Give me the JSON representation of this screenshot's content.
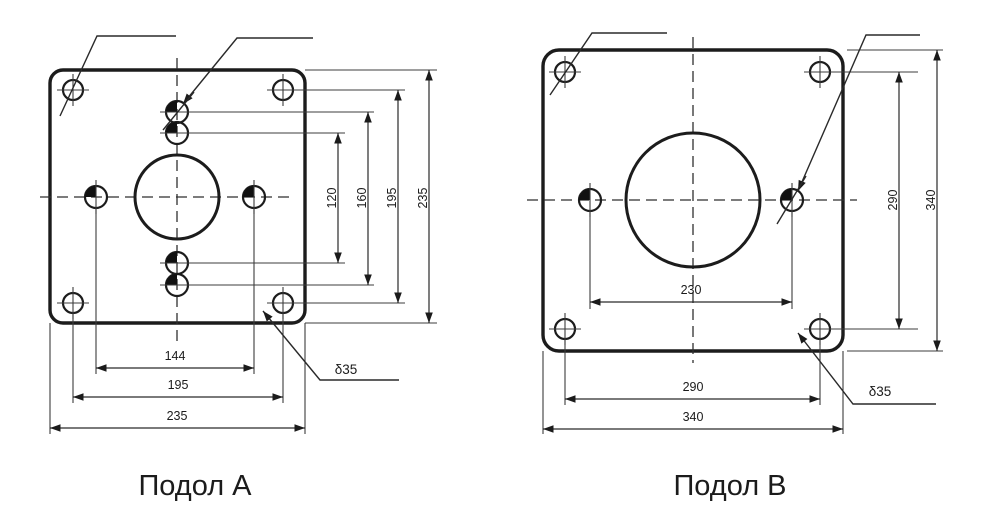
{
  "accent_color": "#1b1b1b",
  "drawing_a": {
    "title": "Подол А",
    "thickness_label": "δ35",
    "dimensions": {
      "inner_hole_spacing_v": "120",
      "outer_hole_spacing_v": "160",
      "corner_hole_spacing_v": "195",
      "plate_height": "235",
      "side_hole_spacing_h": "144",
      "corner_hole_spacing_h": "195",
      "plate_width": "235"
    }
  },
  "drawing_b": {
    "title": "Подол В",
    "thickness_label": "δ35",
    "dimensions": {
      "side_hole_spacing_h": "230",
      "corner_hole_spacing_h": "290",
      "plate_width": "340",
      "corner_hole_spacing_v": "290",
      "plate_height": "340"
    }
  }
}
